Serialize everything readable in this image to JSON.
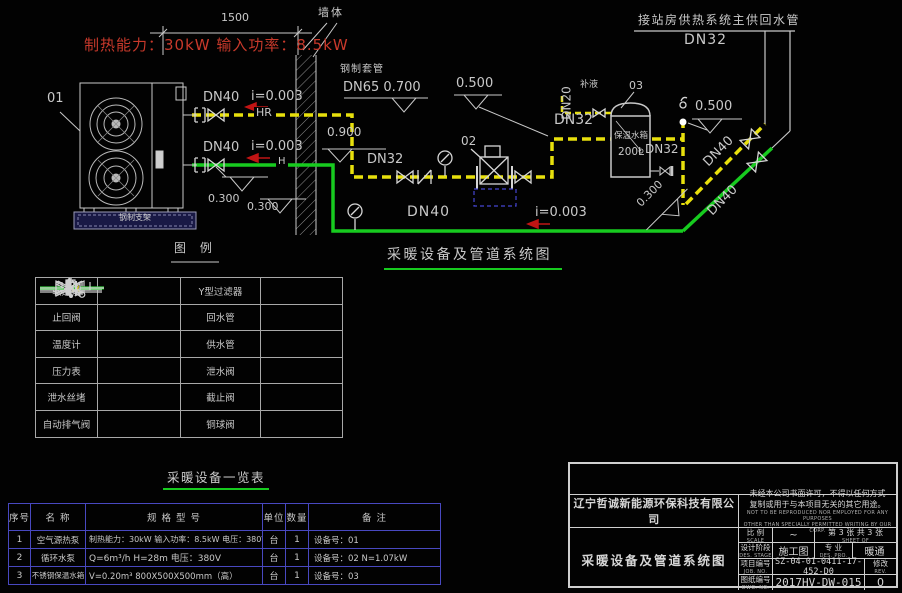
{
  "labels": {
    "capacity": "制热能力：30kW 输入功率：8.5kW",
    "dim": "1500",
    "wall": "墙体",
    "sleeve": "钢制套管",
    "dn65_0700": "DN65 0.700",
    "station_note": "接站房供热系统主供回水管",
    "station_dn": "DN32",
    "dn40": "DN40",
    "dn32": "DN32",
    "dn20": "DN20",
    "slope": "i=0.003",
    "hr": "HR",
    "h": "H",
    "elev_0900": "0.900",
    "elev_0500": "0.500",
    "elev_0300": "0.300",
    "makeup": "补液",
    "tag_unit": "01",
    "tag_pump": "02",
    "tag_tank": "03",
    "tank_name": "保温水箱",
    "tank_vol": "200L",
    "base": "钢制支架",
    "legend_title": "图 例",
    "main_title": "采暖设备及管道系统图",
    "equip_title": "采暖设备一览表"
  },
  "colors": {
    "return_pipe_yellow": "#e8e00c",
    "supply_pipe_green": "#17cb1f",
    "note_red": "#c8392b",
    "slope_arrow_red": "#c01414",
    "table_border_blue": "#4848c0",
    "linework_grey": "#c9c9c9"
  },
  "legend": {
    "items": [
      {
        "label": "软连接",
        "symbol": "flex-connector"
      },
      {
        "label": "Y型过滤器",
        "symbol": "y-strainer"
      },
      {
        "label": "止回阀",
        "symbol": "check-valve"
      },
      {
        "label": "回水管",
        "symbol": "return-pipe"
      },
      {
        "label": "温度计",
        "symbol": "thermometer"
      },
      {
        "label": "供水管",
        "symbol": "supply-pipe"
      },
      {
        "label": "压力表",
        "symbol": "pressure-gauge"
      },
      {
        "label": "泄水阀",
        "symbol": "drain-valve"
      },
      {
        "label": "泄水丝堵",
        "symbol": "drain-plug"
      },
      {
        "label": "截止阀",
        "symbol": "stop-valve"
      },
      {
        "label": "自动排气阀",
        "symbol": "auto-air-vent"
      },
      {
        "label": "铜球阀",
        "symbol": "ball-valve"
      }
    ]
  },
  "equip": {
    "headers": [
      "序号",
      "名  称",
      "规 格 型 号",
      "单位",
      "数量",
      "备  注"
    ],
    "rows": [
      [
        "1",
        "空气源热泵",
        "制热能力：30kW 输入功率：8.5kW 电压：380V",
        "台",
        "1",
        "设备号：01"
      ],
      [
        "2",
        "循环水泵",
        "Q=6m³/h  H=28m  电压：380V",
        "台",
        "1",
        "设备号：02  N=1.07kW"
      ],
      [
        "3",
        "不锈钢保温水箱",
        "V=0.20m³   800X500X500mm（高）",
        "台",
        "1",
        "设备号：03"
      ]
    ]
  },
  "tb": {
    "company": "辽宁哲诚新能源环保科技有限公司",
    "d_cn1": "未经本公司书面许可，不得以任何方式",
    "d_cn2": "复制或用于与本项目无关的其它用途。",
    "d_en1": "NOT TO BE REPRODUCED NOR EMPLOYED FOR ANY PURPOSES",
    "d_en2": "OTHER THAN SPECIALLY PERMITTED WRITING BY OUR CORP.",
    "scale_l": "比  例",
    "scale_en": "SCALE",
    "scale_v": "~",
    "sheet": "第 3 张  共 3 张",
    "sheet_en": "SHEET    OF",
    "stage_l": "设计阶段",
    "stage_en": "DES. STAGE",
    "stage_v": "施工图",
    "pro_l": "专  业",
    "pro_en": "DES. PRO.",
    "pro_v": "暖通",
    "job_l": "项目编号",
    "job_en": "JOB. NO.",
    "job_v": "SZ-04-01-0411-17-452-D0",
    "rev_l": "修改",
    "rev_en": "REV.",
    "rev_v": "0",
    "dwg_l": "图纸编号",
    "dwg_en": "DWG. NO.",
    "dwg_v": "2017HV-DW-015",
    "title": "采暖设备及管道系统图"
  }
}
